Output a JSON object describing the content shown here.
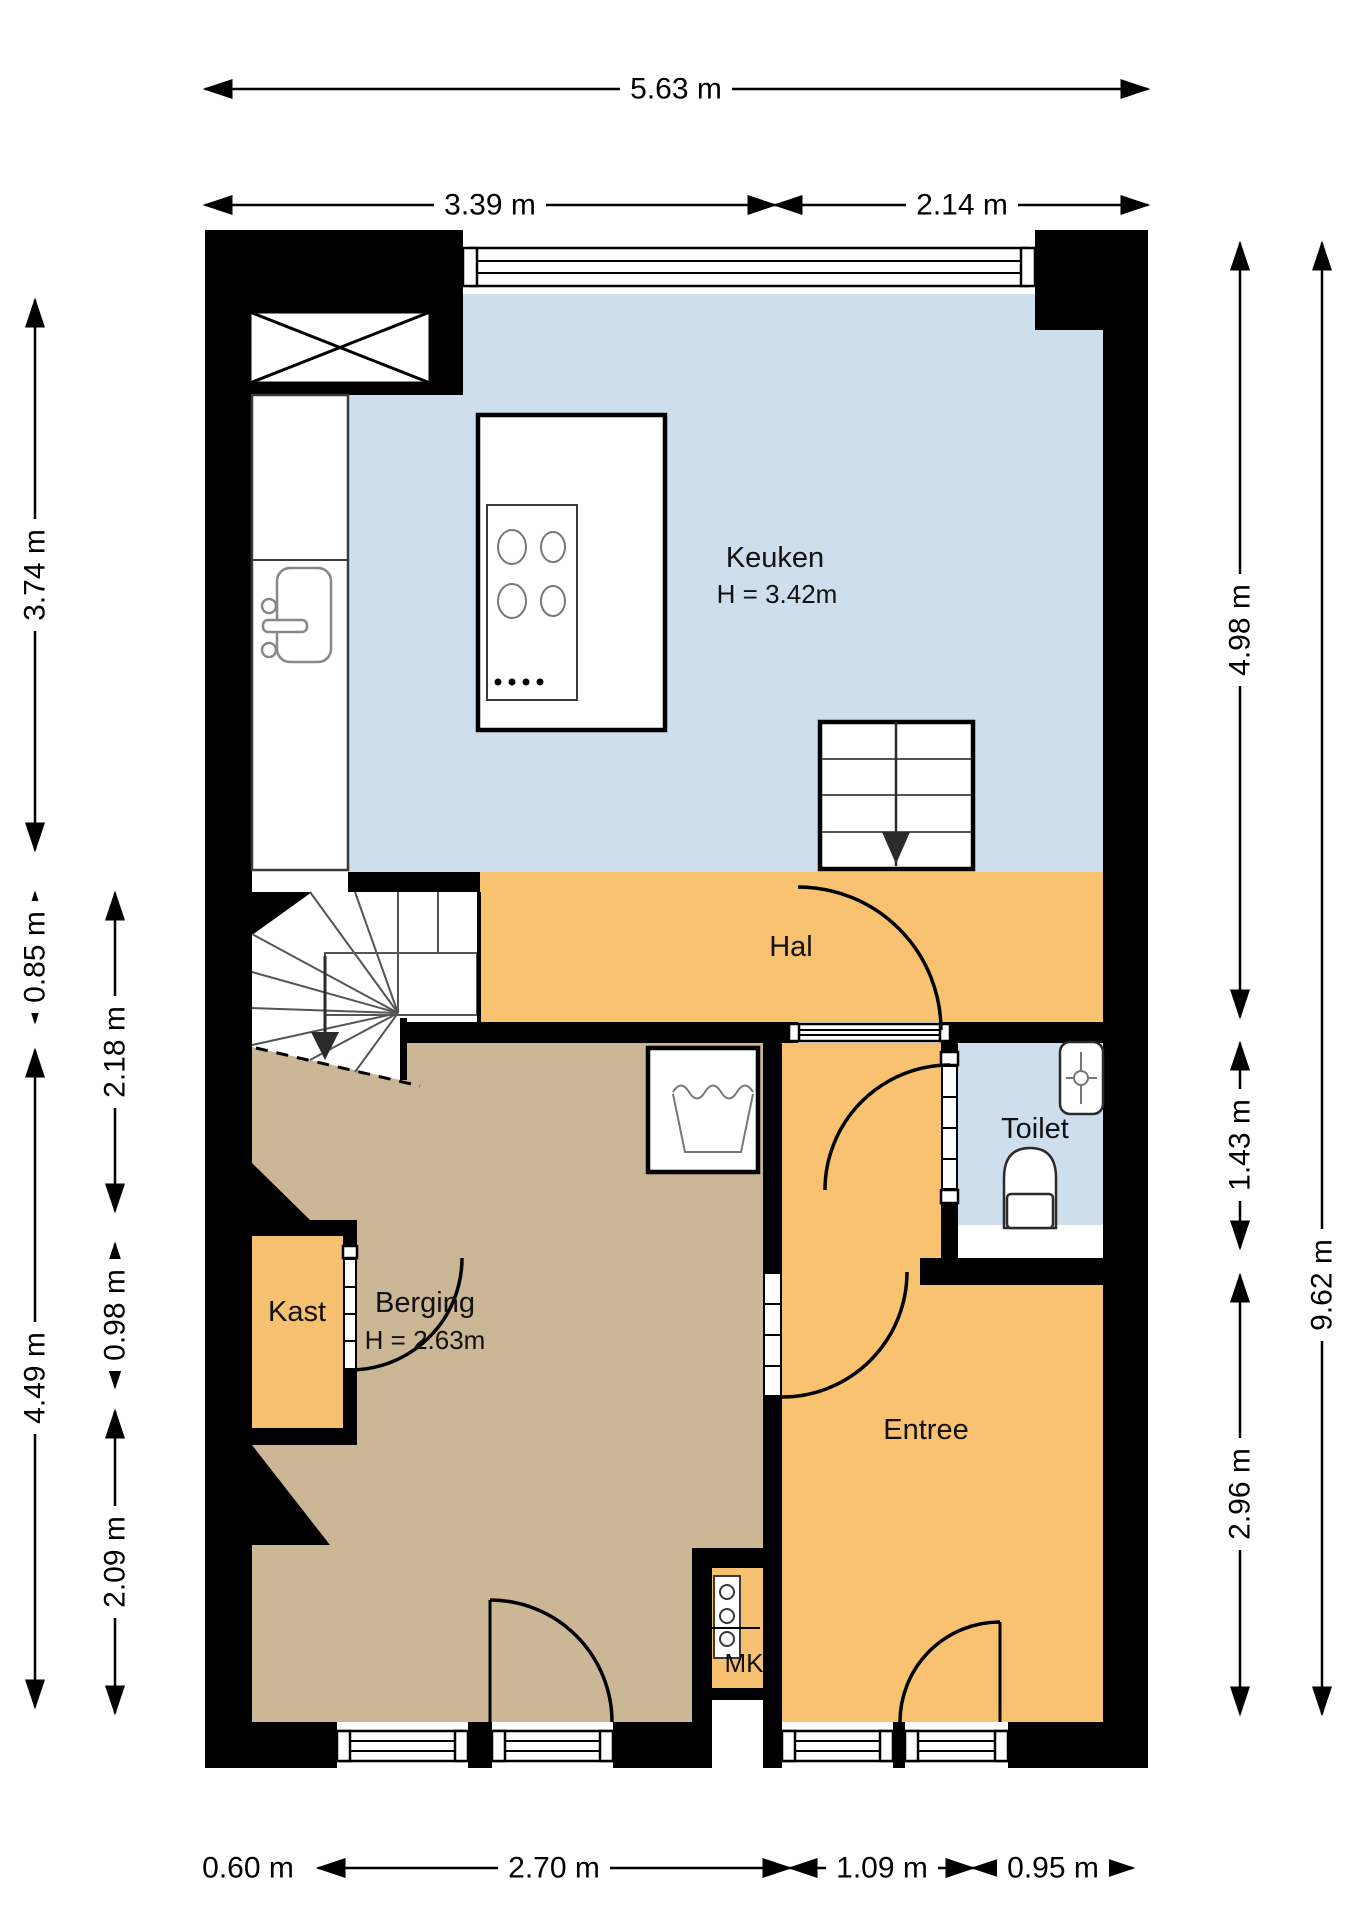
{
  "colors": {
    "wall": "#000000",
    "keuken_floor": "#cfdeed",
    "toilet_floor": "#cfdeed",
    "hal_floor": "#f8c271",
    "entree_floor": "#f8c271",
    "kast_floor": "#f6c171",
    "mk_floor": "#f6c171",
    "berging_floor": "#cbb695"
  },
  "rooms": {
    "keuken": {
      "label": "Keuken",
      "height_label": "H = 3.42m"
    },
    "hal": {
      "label": "Hal"
    },
    "toilet": {
      "label": "Toilet"
    },
    "berging": {
      "label": "Berging",
      "height_label": "H = 2.63m"
    },
    "kast": {
      "label": "Kast"
    },
    "entree": {
      "label": "Entree"
    },
    "mk": {
      "label": "MK"
    }
  },
  "dimensions": {
    "top": [
      {
        "label": "5.63 m"
      },
      {
        "label": "3.39 m"
      },
      {
        "label": "2.14 m"
      }
    ],
    "bottom": [
      {
        "label": "0.60 m"
      },
      {
        "label": "2.70 m"
      },
      {
        "label": "1.09 m"
      },
      {
        "label": "0.95 m"
      }
    ],
    "left": [
      {
        "label": "3.74 m"
      },
      {
        "label": "0.85 m"
      },
      {
        "label": "4.49 m"
      },
      {
        "label": "2.18 m"
      },
      {
        "label": "0.98 m"
      },
      {
        "label": "2.09 m"
      }
    ],
    "right": [
      {
        "label": "4.98 m"
      },
      {
        "label": "1.43 m"
      },
      {
        "label": "2.96 m"
      },
      {
        "label": "9.62 m"
      }
    ]
  }
}
